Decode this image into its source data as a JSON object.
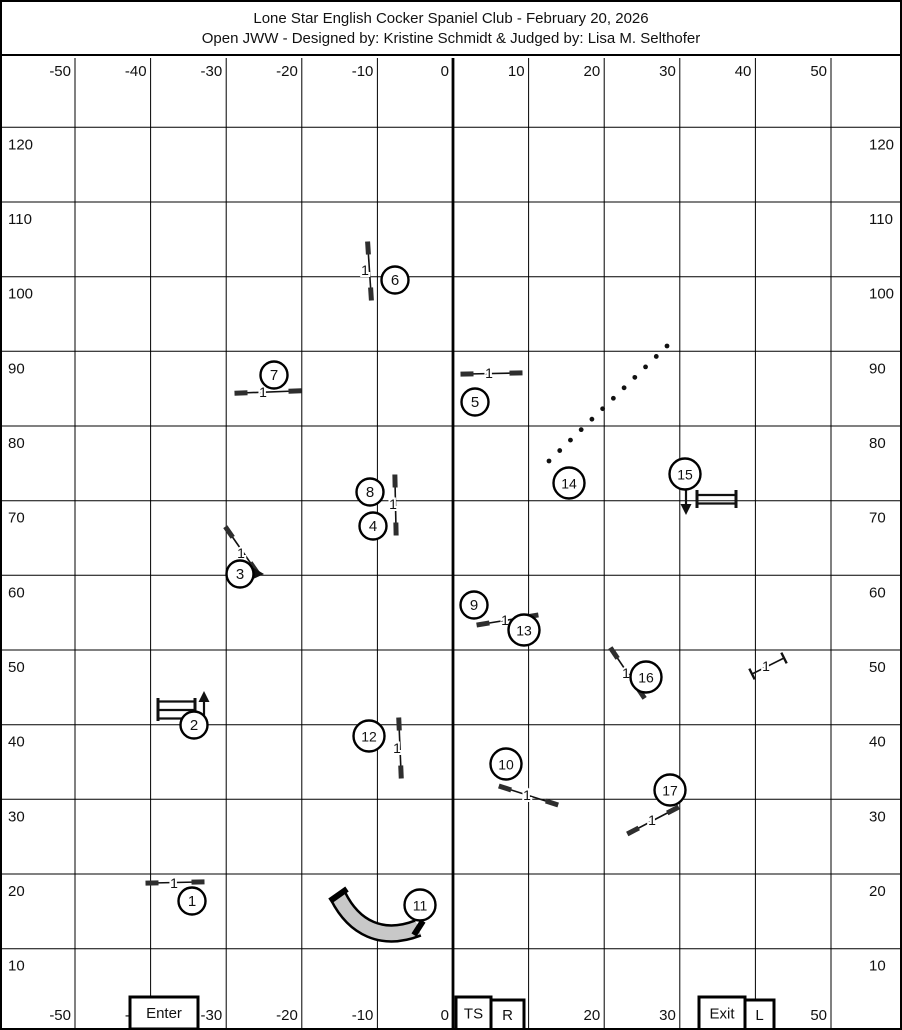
{
  "title": {
    "line1": "Lone Star English Cocker Spaniel Club - February 20, 2026",
    "line2": "Open JWW - Designed by: Kristine Schmidt & Judged by: Lisa M. Selthofer"
  },
  "colors": {
    "ink": "#111111",
    "grid_line": "#000000",
    "jump_cap": "#2e2e2e",
    "tunnel_fill": "#c8c8c8",
    "paper": "#ffffff"
  },
  "grid": {
    "top": 56,
    "bottom": 1028,
    "left": 0,
    "right": 902,
    "bold_x_value": "0",
    "x_labels": [
      {
        "v": "-50",
        "px": 73.0
      },
      {
        "v": "-40",
        "px": 148.6
      },
      {
        "v": "-30",
        "px": 224.2
      },
      {
        "v": "-20",
        "px": 299.8
      },
      {
        "v": "-10",
        "px": 375.4
      },
      {
        "v": "0",
        "px": 451.0
      },
      {
        "v": "10",
        "px": 526.6
      },
      {
        "v": "20",
        "px": 602.2
      },
      {
        "v": "30",
        "px": 677.8
      },
      {
        "v": "40",
        "px": 753.4
      },
      {
        "v": "50",
        "px": 829.0
      }
    ],
    "y_labels": [
      {
        "v": "120",
        "py": 125.3
      },
      {
        "v": "110",
        "py": 200.0
      },
      {
        "v": "100",
        "py": 274.7
      },
      {
        "v": "90",
        "py": 349.3
      },
      {
        "v": "80",
        "py": 424.0
      },
      {
        "v": "70",
        "py": 498.7
      },
      {
        "v": "60",
        "py": 573.3
      },
      {
        "v": "50",
        "py": 648.0
      },
      {
        "v": "40",
        "py": 722.7
      },
      {
        "v": "30",
        "py": 797.3
      },
      {
        "v": "20",
        "py": 872.0
      },
      {
        "v": "10",
        "py": 946.7
      }
    ]
  },
  "obstacles": {
    "circles": [
      {
        "n": "1",
        "x": 190,
        "y": 899
      },
      {
        "n": "2",
        "x": 192,
        "y": 723
      },
      {
        "n": "3",
        "x": 238,
        "y": 572
      },
      {
        "n": "4",
        "x": 371,
        "y": 524
      },
      {
        "n": "5",
        "x": 473,
        "y": 400
      },
      {
        "n": "6",
        "x": 393,
        "y": 278
      },
      {
        "n": "7",
        "x": 272,
        "y": 373
      },
      {
        "n": "8",
        "x": 368,
        "y": 490
      },
      {
        "n": "9",
        "x": 472,
        "y": 603
      },
      {
        "n": "10",
        "x": 504,
        "y": 762
      },
      {
        "n": "11",
        "x": 418,
        "y": 903
      },
      {
        "n": "12",
        "x": 367,
        "y": 734
      },
      {
        "n": "13",
        "x": 522,
        "y": 628
      },
      {
        "n": "14",
        "x": 567,
        "y": 481
      },
      {
        "n": "15",
        "x": 683,
        "y": 472
      },
      {
        "n": "16",
        "x": 644,
        "y": 675
      },
      {
        "n": "17",
        "x": 668,
        "y": 788
      }
    ],
    "jumps": [
      {
        "id": "jump-1",
        "x1": 150,
        "y1": 881,
        "x2": 196,
        "y2": 880,
        "lx": 172,
        "ly": 881,
        "label": "1",
        "caps": "wing"
      },
      {
        "id": "jump-3",
        "x1": 227,
        "y1": 530,
        "x2": 252,
        "y2": 566,
        "lx": 239,
        "ly": 551,
        "label": "1",
        "caps": "wing"
      },
      {
        "id": "jump-4-8",
        "x1": 393,
        "y1": 479,
        "x2": 394,
        "y2": 527,
        "lx": 391,
        "ly": 502,
        "label": "1",
        "caps": "wing"
      },
      {
        "id": "jump-5",
        "x1": 465,
        "y1": 372,
        "x2": 514,
        "y2": 371,
        "lx": 487,
        "ly": 371,
        "label": "1",
        "caps": "wing"
      },
      {
        "id": "jump-6",
        "x1": 366,
        "y1": 246,
        "x2": 369,
        "y2": 292,
        "lx": 363,
        "ly": 268,
        "label": "1",
        "caps": "wing"
      },
      {
        "id": "jump-7",
        "x1": 239,
        "y1": 391,
        "x2": 293,
        "y2": 389,
        "lx": 261,
        "ly": 390,
        "label": "1",
        "caps": "wing"
      },
      {
        "id": "jump-9-13",
        "x1": 481,
        "y1": 622,
        "x2": 530,
        "y2": 614,
        "lx": 503,
        "ly": 618,
        "label": "1",
        "caps": "wing"
      },
      {
        "id": "jump-10",
        "x1": 503,
        "y1": 786,
        "x2": 550,
        "y2": 801,
        "lx": 525,
        "ly": 793,
        "label": "1",
        "caps": "wing"
      },
      {
        "id": "jump-12",
        "x1": 397,
        "y1": 722,
        "x2": 399,
        "y2": 770,
        "lx": 395,
        "ly": 746,
        "label": "1",
        "caps": "wing"
      },
      {
        "id": "jump-16",
        "x1": 612,
        "y1": 651,
        "x2": 639,
        "y2": 691,
        "lx": 624,
        "ly": 671,
        "label": "1",
        "caps": "wing"
      },
      {
        "id": "jump-17",
        "x1": 631,
        "y1": 829,
        "x2": 671,
        "y2": 808,
        "lx": 650,
        "ly": 818,
        "label": "1",
        "caps": "wing"
      },
      {
        "id": "jump-unnumbered",
        "x1": 750,
        "y1": 672,
        "x2": 782,
        "y2": 656,
        "lx": 764,
        "ly": 664,
        "label": "1",
        "caps": "tick"
      }
    ],
    "spreads": [
      {
        "id": "spread-2",
        "x1": 156,
        "x2": 193,
        "post_y1": 696,
        "post_y2": 719,
        "rails": [
          699.5,
          708.0,
          716.5
        ],
        "arrow": {
          "x": 202,
          "y_from": 717,
          "y_to": 700,
          "tip_y": 689,
          "dir": "up"
        }
      },
      {
        "id": "spread-15",
        "x1": 695,
        "x2": 734,
        "post_y1": 488,
        "post_y2": 506,
        "rails": [
          493.0,
          501.5
        ],
        "arrow": {
          "x": 684,
          "y_from": 486,
          "y_to": 504,
          "tip_y": 513,
          "dir": "down"
        }
      }
    ],
    "weaves": {
      "id": "weave-14",
      "x1": 665,
      "y1": 344,
      "x2": 547,
      "y2": 459,
      "poles": 12
    },
    "tunnel": {
      "id": "tunnel-11",
      "path": "M 336,894 C 352,926 380,940 416,926",
      "caps": [
        [
          328,
          899,
          345,
          887
        ],
        [
          412,
          933,
          421,
          919
        ]
      ]
    },
    "direction_marker_3": {
      "points": "262,572 250,565 249,578"
    }
  },
  "footer_boxes": [
    {
      "label": "Enter",
      "x": 128,
      "y": 995,
      "w": 68,
      "h": 32
    },
    {
      "label": "TS",
      "x": 454,
      "y": 995,
      "w": 35,
      "h": 33
    },
    {
      "label": "R",
      "x": 489,
      "y": 998,
      "w": 33,
      "h": 30
    },
    {
      "label": "Exit",
      "x": 697,
      "y": 995,
      "w": 46,
      "h": 33
    },
    {
      "label": "L",
      "x": 743,
      "y": 998,
      "w": 29,
      "h": 30
    }
  ]
}
